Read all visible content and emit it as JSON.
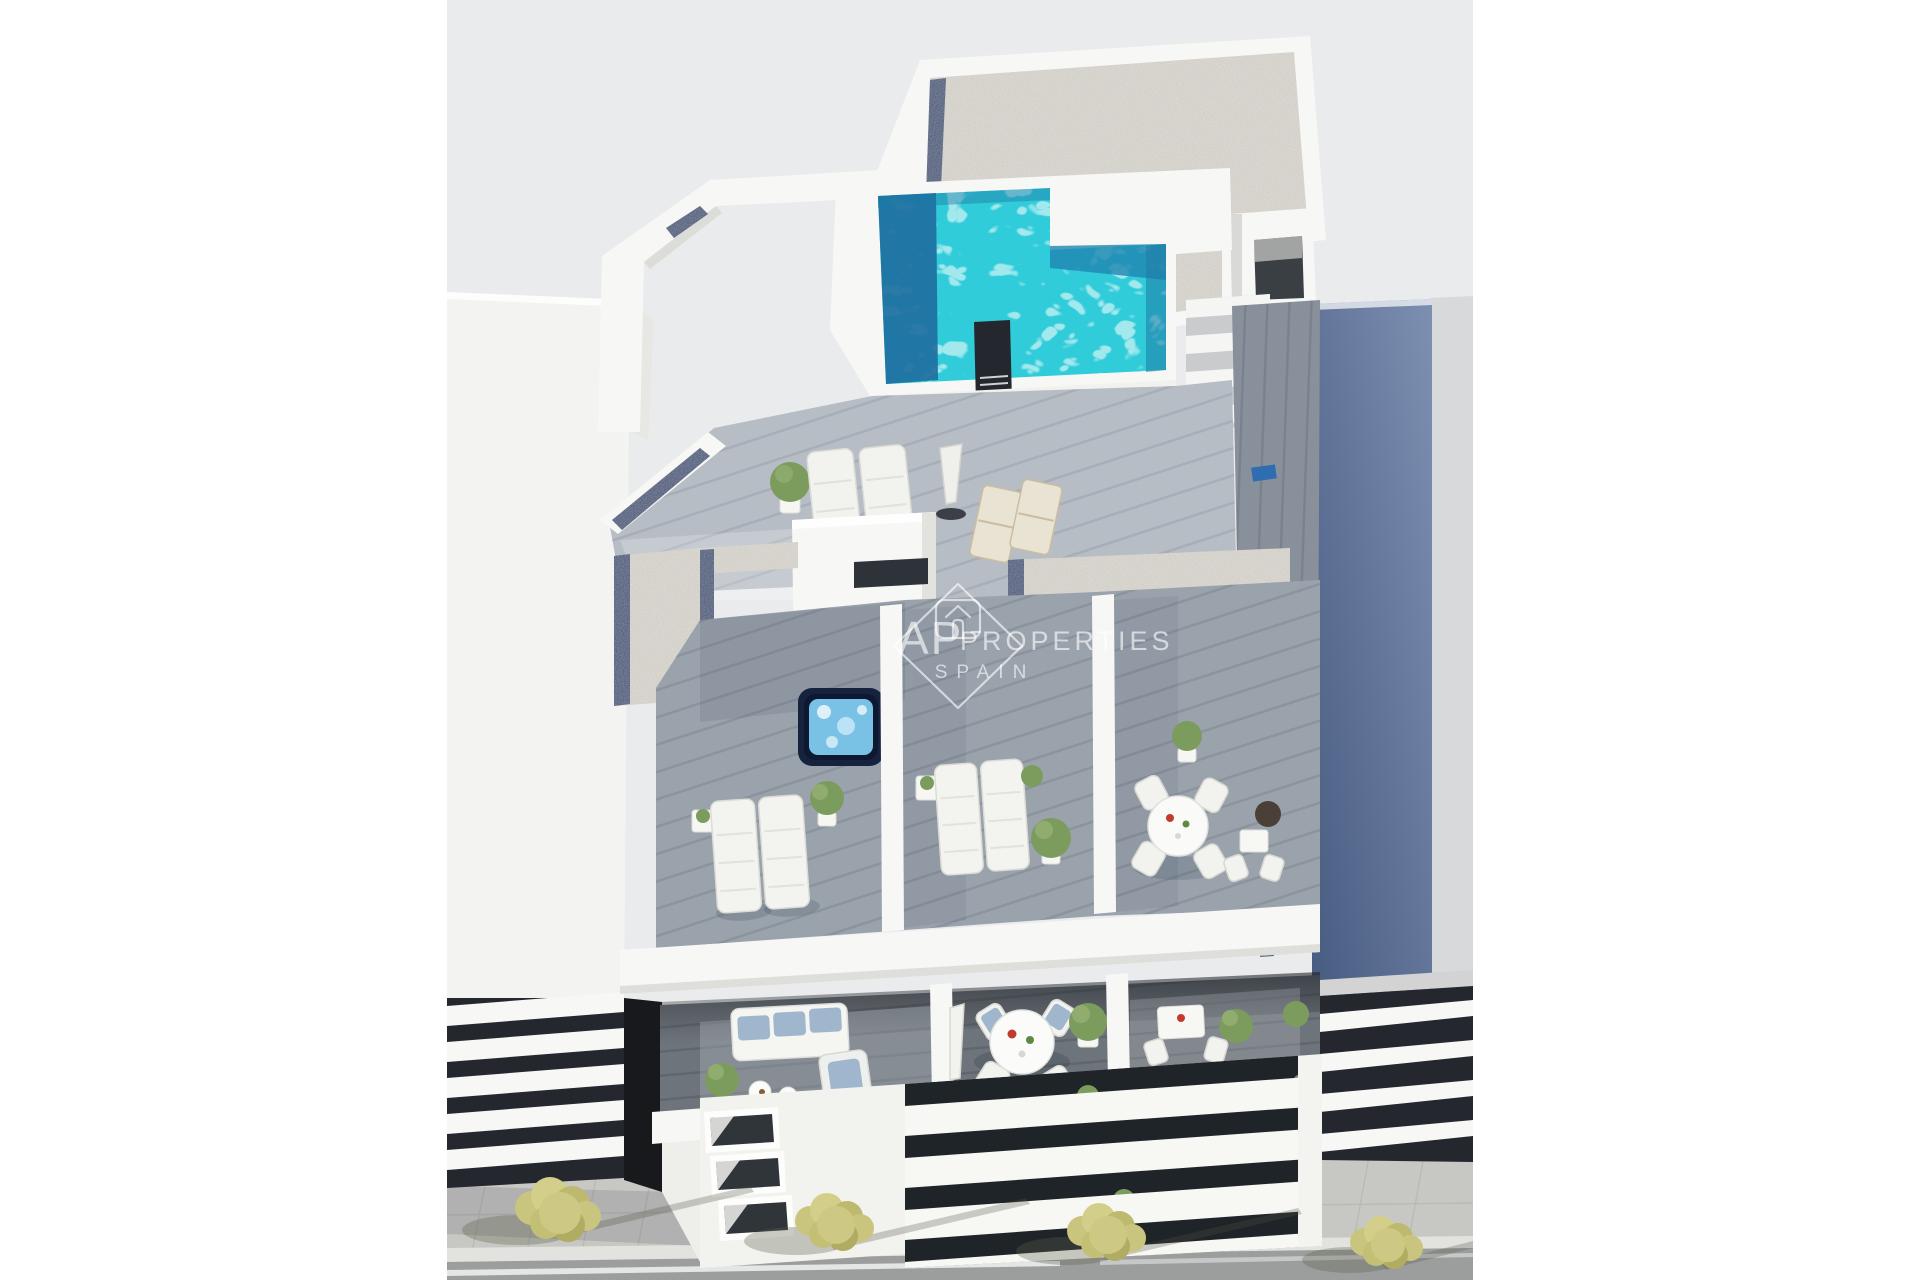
{
  "photo": {
    "alt": "Aerial 3D architectural render of a modern white apartment building: rooftop terrace with turquoise swimming pool, gravel roofs, wooden sun decks with loungers, jacuzzi, dining terraces and balconies, neighbouring white buildings and a street with yellow-green trees below"
  },
  "watermark": {
    "brand_prefix": "AP",
    "brand_name": "PROPERTIES",
    "brand_region": "SPAIN",
    "logo": "house-in-diamond-icon"
  },
  "scene": {
    "features": [
      "rooftop-pool",
      "gravel-roof",
      "wood-deck-terraces",
      "sun-loungers",
      "jacuzzi",
      "round-dining-tables",
      "balcony-sofa",
      "street-sidewalk",
      "yellow-green-trees",
      "neighbour-buildings"
    ]
  },
  "colors": {
    "page_background": "#ffffff",
    "sky_backdrop": "#eaebed",
    "white_building": "#f7f7f5",
    "gravel": "#e2dfd8",
    "accent_navy": "#2c4a7c",
    "pool_turquoise": "#30ccd9",
    "pool_deep_blue": "#1f6f9f",
    "wood_deck_light": "#b7bdc5",
    "wood_deck_mid": "#9aa2ac",
    "wood_balcony_dark": "#6e747b",
    "walkway_wood": "#87909b",
    "slate_wall": "#5c719a",
    "louver_dark": "#24282e",
    "sidewalk": "#c7c8c3",
    "street_asphalt": "#9b9e9d",
    "foliage_green": "#7c9c5e",
    "tree_yellow_green": "#c6c37a",
    "watermark_white": "rgba(255,255,255,0.62)"
  }
}
